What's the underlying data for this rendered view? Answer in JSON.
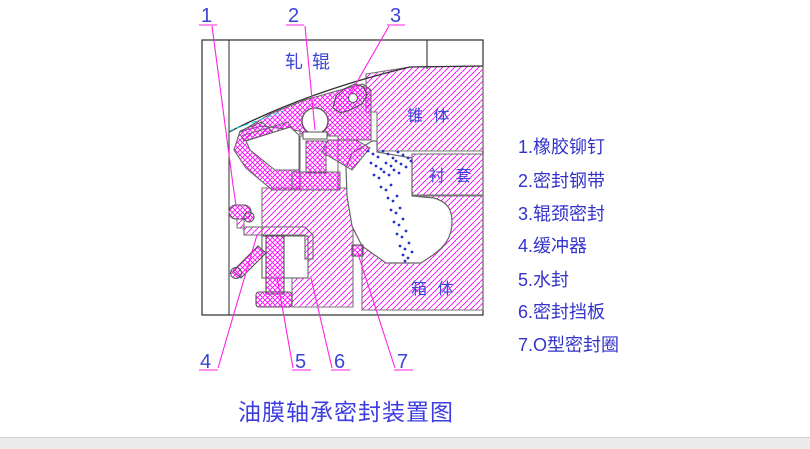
{
  "title": {
    "text": "油膜轴承密封装置图"
  },
  "drawing": {
    "area_labels": {
      "roll": "轧 辊",
      "cone": "锥 体",
      "bushing": "衬 套",
      "housing": "箱 体"
    },
    "callouts": [
      {
        "num": "1"
      },
      {
        "num": "2"
      },
      {
        "num": "3"
      },
      {
        "num": "4"
      },
      {
        "num": "5"
      },
      {
        "num": "6"
      },
      {
        "num": "7"
      }
    ],
    "droplets": [
      [
        368,
        151
      ],
      [
        373,
        154
      ],
      [
        378,
        157
      ],
      [
        383,
        151
      ],
      [
        388,
        154
      ],
      [
        393,
        158
      ],
      [
        398,
        152
      ],
      [
        403,
        155
      ],
      [
        408,
        158
      ],
      [
        371,
        163
      ],
      [
        376,
        166
      ],
      [
        381,
        169
      ],
      [
        386,
        163
      ],
      [
        391,
        166
      ],
      [
        396,
        161
      ],
      [
        401,
        164
      ],
      [
        406,
        167
      ],
      [
        411,
        161
      ],
      [
        374,
        175
      ],
      [
        379,
        178
      ],
      [
        384,
        172
      ],
      [
        389,
        175
      ],
      [
        394,
        170
      ],
      [
        399,
        173
      ],
      [
        381,
        187
      ],
      [
        386,
        190
      ],
      [
        391,
        185
      ],
      [
        388,
        198
      ],
      [
        393,
        201
      ],
      [
        397,
        196
      ],
      [
        391,
        210
      ],
      [
        396,
        213
      ],
      [
        400,
        208
      ],
      [
        394,
        222
      ],
      [
        399,
        225
      ],
      [
        403,
        219
      ],
      [
        397,
        234
      ],
      [
        402,
        237
      ],
      [
        406,
        231
      ],
      [
        400,
        246
      ],
      [
        405,
        249
      ],
      [
        409,
        243
      ],
      [
        403,
        255
      ],
      [
        408,
        258
      ],
      [
        412,
        252
      ],
      [
        405,
        261
      ]
    ]
  },
  "legend": {
    "items": [
      {
        "label": "1.橡胶铆钉"
      },
      {
        "label": "2.密封钢带"
      },
      {
        "label": "3.辊颈密封"
      },
      {
        "label": "4.缓冲器"
      },
      {
        "label": "5.水封"
      },
      {
        "label": "6.密封挡板"
      },
      {
        "label": "7.O型密封圈"
      }
    ]
  },
  "colors": {
    "hatch_magenta": "#ff00ff",
    "leader_magenta": "#ff22e6",
    "label_blue": "#3a45d6",
    "title_blue": "#3c3ce0",
    "droplet_blue": "#2233cc",
    "centerline_cyan": "#00dde8",
    "outline_gray": "#5a5a5a",
    "frame_black": "#2b2b2b"
  }
}
